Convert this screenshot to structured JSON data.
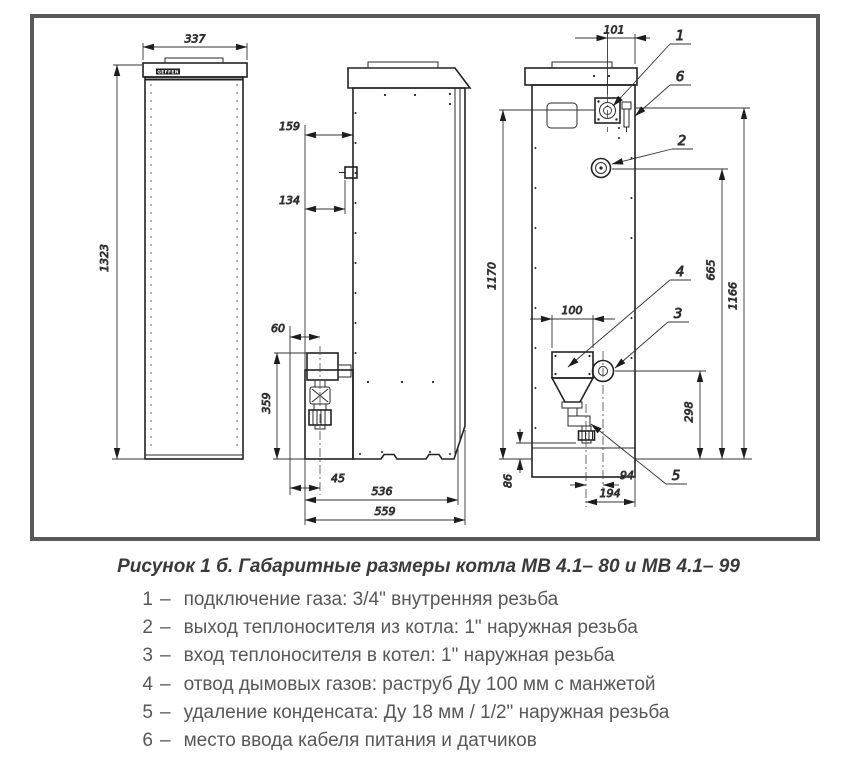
{
  "drawing": {
    "brand": "GEFFEN",
    "line_color": "#222222",
    "frame_color": "#59595a"
  },
  "dims": {
    "front_width": "337",
    "front_height": "1323",
    "side_top_offset": "159",
    "side_fitting_offset": "134",
    "side_trap_offset": "60",
    "side_trap_height": "359",
    "side_drain_offset": "45",
    "side_depth_inner": "536",
    "side_depth": "559",
    "back_gas_offset": "101",
    "back_gas_height": "1170",
    "back_cable_height": "1166",
    "back_outlet_height": "665",
    "back_flue_width": "100",
    "back_inlet_height": "298",
    "back_condensate_height": "86",
    "back_condensate_offset": "94",
    "back_condensate_edge": "194"
  },
  "callouts": {
    "gas": "1",
    "outlet": "2",
    "inlet": "3",
    "flue": "4",
    "condensate": "5",
    "cable": "6"
  },
  "caption": "Рисунок 1 б. Габаритные размеры котла МВ 4.1– 80 и МВ 4.1– 99",
  "legend": {
    "items": [
      {
        "num": "1",
        "dash": "–",
        "text": "подключение газа: 3/4\" внутренняя резьба"
      },
      {
        "num": "2",
        "dash": "–",
        "text": "выход теплоносителя из котла: 1\" наружная резьба"
      },
      {
        "num": "3",
        "dash": "–",
        "text": "вход теплоносителя в котел: 1\" наружная резьба"
      },
      {
        "num": "4",
        "dash": "–",
        "text": "отвод дымовых газов: раструб Ду 100 мм с манжетой"
      },
      {
        "num": "5",
        "dash": "–",
        "text": "удаление конденсата: Ду 18 мм / 1/2\" наружная резьба"
      },
      {
        "num": "6",
        "dash": "–",
        "text": "место ввода кабеля питания и датчиков"
      }
    ]
  }
}
